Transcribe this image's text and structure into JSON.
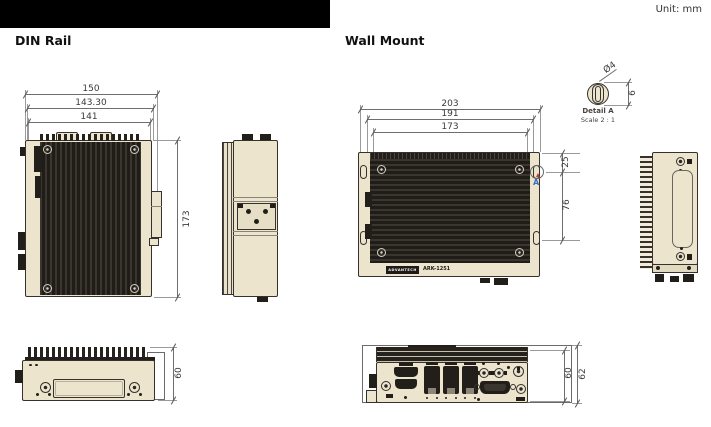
{
  "unit_label": "Unit: mm",
  "din": {
    "title": "DIN Rail",
    "plan": {
      "width_overall": "150",
      "width_mid": "143.30",
      "width_inner": "141",
      "depth": "173"
    },
    "front": {
      "height": "60"
    }
  },
  "wall": {
    "title": "Wall Mount",
    "plan": {
      "width_overall": "203",
      "width_mid": "191",
      "width_inner": "173",
      "hole_top_offset": "25",
      "hole_spacing": "76"
    },
    "front": {
      "height_body": "60",
      "height_overall": "62"
    },
    "detail": {
      "name": "Detail A",
      "scale": "Scale 2 : 1",
      "hole_dia": "Ø4",
      "slot_len": "6",
      "marker": "A"
    },
    "label": {
      "brand": "ADVANTECH",
      "model": "ARK-1251"
    }
  }
}
